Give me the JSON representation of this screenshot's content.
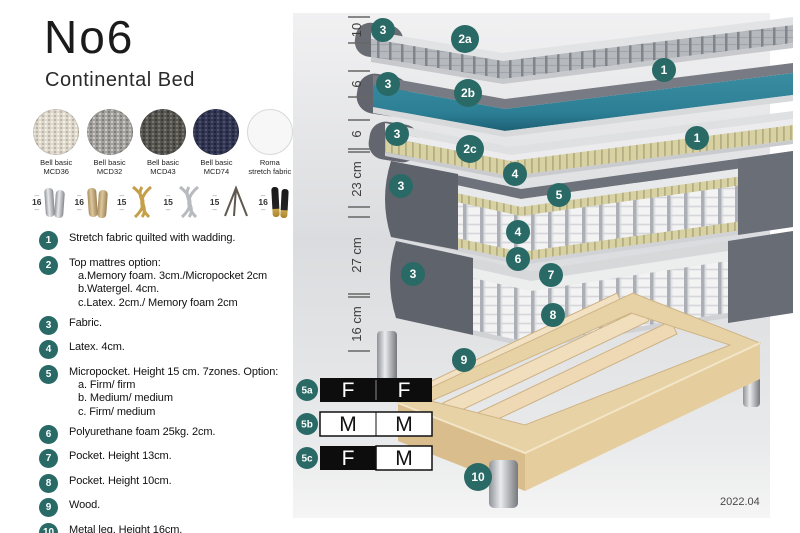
{
  "header": {
    "title": "No6",
    "subtitle": "Continental Bed"
  },
  "swatches": [
    {
      "line1": "Bell basic",
      "line2": "MCD36",
      "color": "#ddd8cb"
    },
    {
      "line1": "Bell basic",
      "line2": "MCD32",
      "color": "#a3a19d"
    },
    {
      "line1": "Bell basic",
      "line2": "MCD43",
      "color": "#57554f"
    },
    {
      "line1": "Bell basic",
      "line2": "MCD74",
      "color": "#323650"
    },
    {
      "line1": "Roma",
      "line2": "stretch fabric",
      "color": "#f7f7f7"
    }
  ],
  "legs": [
    {
      "height": "16",
      "style": "cylinder-silver"
    },
    {
      "height": "16",
      "style": "cylinder-wood"
    },
    {
      "height": "15",
      "style": "twisted-gold"
    },
    {
      "height": "15",
      "style": "twisted-silver"
    },
    {
      "height": "15",
      "style": "hairpin"
    },
    {
      "height": "16",
      "style": "cylinder-black-gold"
    }
  ],
  "list": [
    {
      "num": "1",
      "text": "Stretch fabric quilted with wadding.",
      "sub1": "",
      "sub2": "",
      "sub3": ""
    },
    {
      "num": "2",
      "text": "Top mattres option:",
      "sub1": "a.Memory foam. 3cm./Micropocket 2cm",
      "sub2": "b.Watergel. 4cm.",
      "sub3": "c.Latex. 2cm./ Memory foam 2cm"
    },
    {
      "num": "3",
      "text": "Fabric.",
      "sub1": "",
      "sub2": "",
      "sub3": ""
    },
    {
      "num": "4",
      "text": "Latex. 4cm.",
      "sub1": "",
      "sub2": "",
      "sub3": ""
    },
    {
      "num": "5",
      "text": "Micropocket. Height 15 cm. 7zones. Option:",
      "sub1": "a. Firm/ firm",
      "sub2": "b. Medium/ medium",
      "sub3": "c. Firm/ medium"
    },
    {
      "num": "6",
      "text": "Polyurethane foam 25kg. 2cm.",
      "sub1": "",
      "sub2": "",
      "sub3": ""
    },
    {
      "num": "7",
      "text": "Pocket. Height 13cm.",
      "sub1": "",
      "sub2": "",
      "sub3": ""
    },
    {
      "num": "8",
      "text": "Pocket. Height 10cm.",
      "sub1": "",
      "sub2": "",
      "sub3": ""
    },
    {
      "num": "9",
      "text": "Wood.",
      "sub1": "",
      "sub2": "",
      "sub3": ""
    },
    {
      "num": "10",
      "text": "Metal leg. Height 16cm.",
      "sub1": "",
      "sub2": "",
      "sub3": ""
    }
  ],
  "diagram": {
    "dimensions": [
      "10",
      "6",
      "6",
      "23 cm",
      "27 cm",
      "16 cm"
    ],
    "badges": [
      "3",
      "2a",
      "1",
      "3",
      "2b",
      "1",
      "3",
      "2c",
      "4",
      "3",
      "5",
      "4",
      "6",
      "3",
      "7",
      "8",
      "9",
      "10"
    ],
    "firmness": [
      {
        "id": "5a",
        "left": "F",
        "right": "F",
        "left_bg": "black",
        "right_bg": "black"
      },
      {
        "id": "5b",
        "left": "M",
        "right": "M",
        "left_bg": "white",
        "right_bg": "white"
      },
      {
        "id": "5c",
        "left": "F",
        "right": "M",
        "left_bg": "black",
        "right_bg": "white"
      }
    ],
    "version": "2022.04",
    "colors": {
      "badge_teal": "#2a6a66",
      "layer_teal": "#2f8398",
      "latex_yellow": "#d8d1a2",
      "wood": "#e7d2a6"
    }
  }
}
